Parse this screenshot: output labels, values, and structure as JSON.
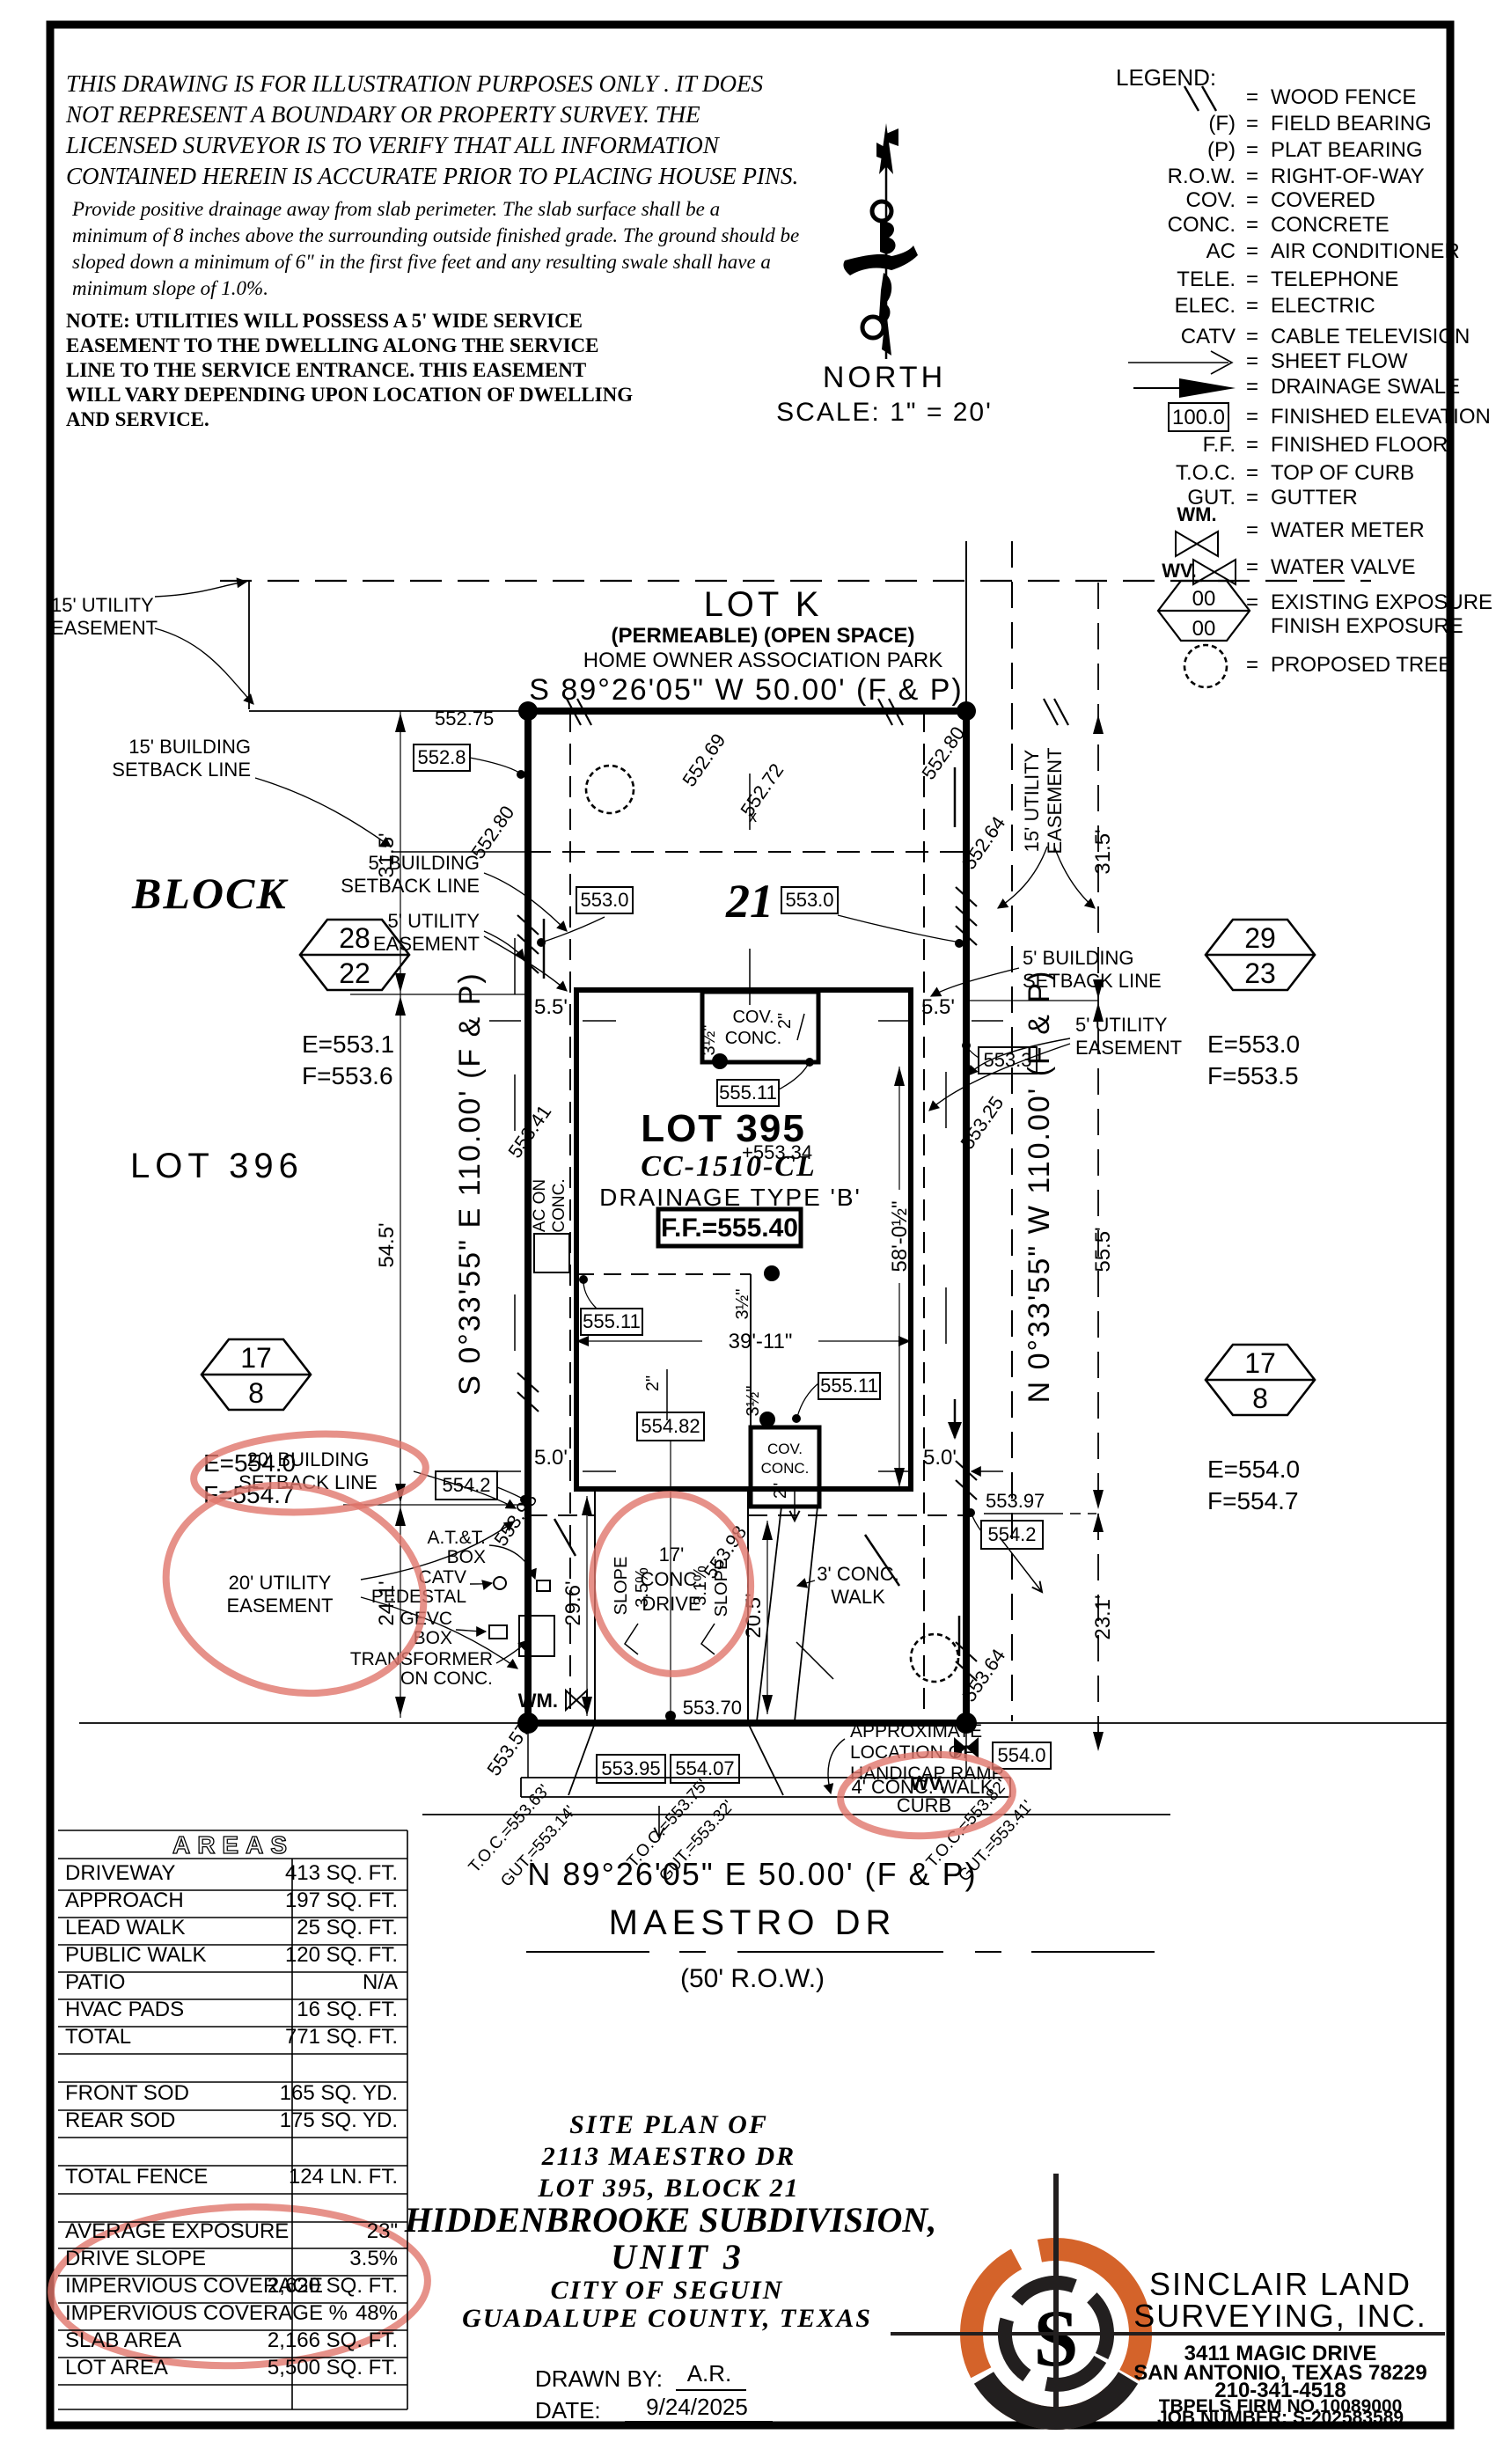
{
  "colors": {
    "ink": "#000000",
    "annotation": "#e0756b",
    "logo_orange": "#d4632a",
    "logo_dark": "#221f1f"
  },
  "disclaimer": {
    "para1": [
      "THIS DRAWING IS FOR ILLUSTRATION PURPOSES ONLY . IT DOES",
      "NOT REPRESENT A BOUNDARY OR PROPERTY SURVEY. THE",
      "LICENSED SURVEYOR IS TO VERIFY THAT ALL INFORMATION",
      "CONTAINED HEREIN IS ACCURATE PRIOR TO PLACING HOUSE PINS."
    ],
    "para2": [
      "Provide positive drainage away from slab perimeter. The slab surface shall be a",
      "minimum of 8 inches above the surrounding outside finished grade. The ground should be",
      "sloped down a minimum of 6\" in the first five feet and any resulting swale shall have a",
      "minimum slope of 1.0%."
    ],
    "note": [
      "NOTE:  UTILITIES  WILL  POSSESS  A  5'  WIDE  SERVICE",
      "EASEMENT  TO  THE  DWELLING  ALONG  THE  SERVICE",
      "LINE  TO  THE  SERVICE  ENTRANCE.  THIS  EASEMENT",
      "WILL  VARY  DEPENDING  UPON  LOCATION  OF  DWELLING",
      "AND  SERVICE."
    ]
  },
  "north": {
    "label": "NORTH",
    "scale": "SCALE:  1\" = 20'"
  },
  "legend": {
    "title": "LEGEND:",
    "eq": "=",
    "rows": [
      {
        "abbr": "",
        "label": "WOOD FENCE",
        "sym": "wood-fence"
      },
      {
        "abbr": "(F)",
        "label": "FIELD BEARING"
      },
      {
        "abbr": "(P)",
        "label": "PLAT BEARING"
      },
      {
        "abbr": "R.O.W.",
        "label": "RIGHT-OF-WAY"
      },
      {
        "abbr": "COV.",
        "label": "COVERED"
      },
      {
        "abbr": "CONC.",
        "label": "CONCRETE"
      },
      {
        "abbr": "AC",
        "label": "AIR CONDITIONER"
      },
      {
        "abbr": "TELE.",
        "label": "TELEPHONE"
      },
      {
        "abbr": "ELEC.",
        "label": "ELECTRIC"
      },
      {
        "abbr": "CATV",
        "label": "CABLE TELEVISION"
      },
      {
        "abbr": "",
        "label": "SHEET FLOW",
        "sym": "sheet-flow-arrow"
      },
      {
        "abbr": "",
        "label": "DRAINAGE SWALE",
        "sym": "drainage-swale-arrow"
      },
      {
        "abbr": "100.0",
        "label": "FINISHED ELEVATION",
        "sym": "finished-elevation-box"
      },
      {
        "abbr": "F.F.",
        "label": "FINISHED FLOOR"
      },
      {
        "abbr": "T.O.C.",
        "label": "TOP OF CURB"
      },
      {
        "abbr": "GUT.",
        "label": "GUTTER"
      },
      {
        "abbr": "WM.",
        "label": "WATER METER",
        "sym": "water-meter"
      },
      {
        "abbr": "WV.",
        "label": "WATER VALVE",
        "sym": "water-valve"
      },
      {
        "abbr": "00",
        "abbr2": "00",
        "label": "EXISTING EXPOSURE",
        "label2": "FINISH EXPOSURE",
        "sym": "exposure-hexagon"
      },
      {
        "abbr": "",
        "label": "PROPOSED TREE",
        "sym": "proposed-tree"
      }
    ]
  },
  "plat": {
    "lot_k": "LOT K",
    "lot_k_note1": "(PERMEABLE) (OPEN SPACE)",
    "lot_k_note2": "HOME OWNER ASSOCIATION PARK",
    "brg_n": "S 89°26'05\" W 50.00' (F & P)",
    "brg_s": "N 89°26'05\" E 50.00' (F & P)",
    "brg_w": "S 0°33'55\" E 110.00' (F & P)",
    "brg_e": "N 0°33'55\" W 110.00' (F & P)",
    "street": "MAESTRO DR",
    "row50": "(50' R.O.W.)",
    "ue15a": "15' UTILITY",
    "ue15b": "EASEMENT",
    "bs15a": "15' BUILDING",
    "bs15b": "SETBACK LINE",
    "bs5a": "5' BUILDING",
    "bs5b": "SETBACK LINE",
    "ue5a": "5' UTILITY",
    "ue5b": "EASEMENT",
    "bs20a": "20' BUILDING",
    "bs20b": "SETBACK LINE",
    "ue20a": "20' UTILITY",
    "ue20b": "EASEMENT",
    "block_word": "BLOCK",
    "block21": "21",
    "lot396": "LOT 396",
    "lot395": "LOT 395",
    "model": "CC-1510-CL",
    "drainage": "DRAINAGE TYPE 'B'",
    "ff": "F.F.=555.40",
    "hex1_top": "28",
    "hex1_bot": "22",
    "hex1_e": "E=553.1",
    "hex1_f": "F=553.6",
    "hex2_top": "29",
    "hex2_bot": "23",
    "hex2_e": "E=553.0",
    "hex2_f": "F=553.5",
    "hex3_top": "17",
    "hex3_bot": "8",
    "hex3_e": "E=554.0",
    "hex3_f": "F=554.7",
    "hex4_top": "17",
    "hex4_bot": "8",
    "hex4_e": "E=554.0",
    "hex4_f": "F=554.7",
    "d31_5": "31.5'",
    "d54_5": "54.5'",
    "d24_1": "24.1'",
    "d55_5": "55.5'",
    "d23_1": "23.1'",
    "d5_5": "5.5'",
    "d5_0": "5.0'",
    "d29_6": "29.6'",
    "d20_5": "20.5'",
    "d39_11": "39'-11\"",
    "d58": "58'-0½\"",
    "d2in": "2\"",
    "d3half": "3½\"",
    "d17": "17'",
    "e552_75": "552.75",
    "e552_8": "552.8",
    "e552_80": "552.80",
    "e552_69": "552.69",
    "e552_72": "552.72",
    "e552_64": "552.64",
    "e553_0": "553.0",
    "e553_3": "553.3",
    "e553_25": "553.25",
    "e553_34": "+553.34",
    "e553_41": "553.41",
    "e553_57": "553.57",
    "e553_64": "553.64",
    "e553_70": "553.70",
    "e553_95": "553.95",
    "e553_97": "553.97",
    "e553_98": "553.98",
    "e554_0": "554.0",
    "e554_07": "554.07",
    "e554_2": "554.2",
    "e554_82": "554.82",
    "e555_11": "555.11",
    "xmark": "x",
    "cov": "COV.",
    "conc": "CONC.",
    "drive_w": "DRIVE",
    "slope": "SLOPE",
    "s35": "3.5%",
    "s31": "3.1%",
    "walk3a": "3' CONC.",
    "walk3b": "WALK",
    "walk4": "4' CONC. WALK",
    "curb": "CURB",
    "acona": "AC ON",
    "aconb": "CONC.",
    "wm": "WM.",
    "wv": "WV.",
    "att1": "A.T.&T.",
    "att2": "BOX",
    "catv1": "CATV",
    "catv2": "PEDESTAL",
    "gevc1": "GEVC",
    "gevc2": "BOX",
    "xfmr1": "TRANSFORMER",
    "xfmr2": "ON CONC.",
    "hc1": "APPROXIMATE",
    "hc2": "LOCATION OF",
    "hc3": "HANDICAP RAMP",
    "toc0t": "T.O.C.=553.63'",
    "toc0g": "GUT.=553.14'",
    "toc1t": "T.O.C.=553.75'",
    "toc1g": "GUT.=553.32'",
    "toc2t": "T.O.C.=553.82'",
    "toc2g": "GUT.=553.41'"
  },
  "areas": {
    "title": "AREAS",
    "rows": [
      {
        "label": "DRIVEWAY",
        "value": "413 SQ. FT."
      },
      {
        "label": "APPROACH",
        "value": "197 SQ. FT."
      },
      {
        "label": "LEAD WALK",
        "value": "25 SQ. FT."
      },
      {
        "label": "PUBLIC WALK",
        "value": "120 SQ. FT."
      },
      {
        "label": "PATIO",
        "value": "N/A"
      },
      {
        "label": "HVAC PADS",
        "value": "16 SQ. FT."
      },
      {
        "label": "TOTAL",
        "value": "771 SQ. FT."
      },
      {
        "label": "",
        "value": ""
      },
      {
        "label": "FRONT SOD",
        "value": "165 SQ. YD."
      },
      {
        "label": "REAR SOD",
        "value": "175 SQ. YD."
      },
      {
        "label": "",
        "value": ""
      },
      {
        "label": "TOTAL FENCE",
        "value": "124 LN. FT."
      },
      {
        "label": "",
        "value": ""
      },
      {
        "label": "AVERAGE EXPOSURE",
        "value": "23\""
      },
      {
        "label": "DRIVE SLOPE",
        "value": "3.5%"
      },
      {
        "label": "IMPERVIOUS COVERAGE",
        "value": "2,620 SQ. FT."
      },
      {
        "label": "IMPERVIOUS COVERAGE %",
        "value": "48%"
      },
      {
        "label": "SLAB AREA",
        "value": "2,166 SQ. FT."
      },
      {
        "label": "LOT AREA",
        "value": "5,500 SQ. FT."
      },
      {
        "label": "",
        "value": ""
      }
    ]
  },
  "title_block": {
    "line1": "SITE PLAN OF",
    "line2": "2113 MAESTRO DR",
    "line3": "LOT 395, BLOCK 21",
    "line4": "HIDDENBROOKE SUBDIVISION,",
    "line5": "UNIT 3",
    "line6": "CITY OF SEGUIN",
    "line7": "GUADALUPE COUNTY, TEXAS",
    "drawn_by_label": "DRAWN BY:",
    "drawn_by": "A.R.",
    "date_label": "DATE:",
    "date": "9/24/2025"
  },
  "surveyor": {
    "name1": "SINCLAIR LAND",
    "name2": "SURVEYING, INC.",
    "addr1": "3411 MAGIC DRIVE",
    "addr2": "SAN ANTONIO, TEXAS 78229",
    "phone": "210-341-4518",
    "firm": "TBPELS FIRM NO.10089000",
    "job": "JOB NUMBER: S-202583589",
    "logo_letter": "S"
  }
}
